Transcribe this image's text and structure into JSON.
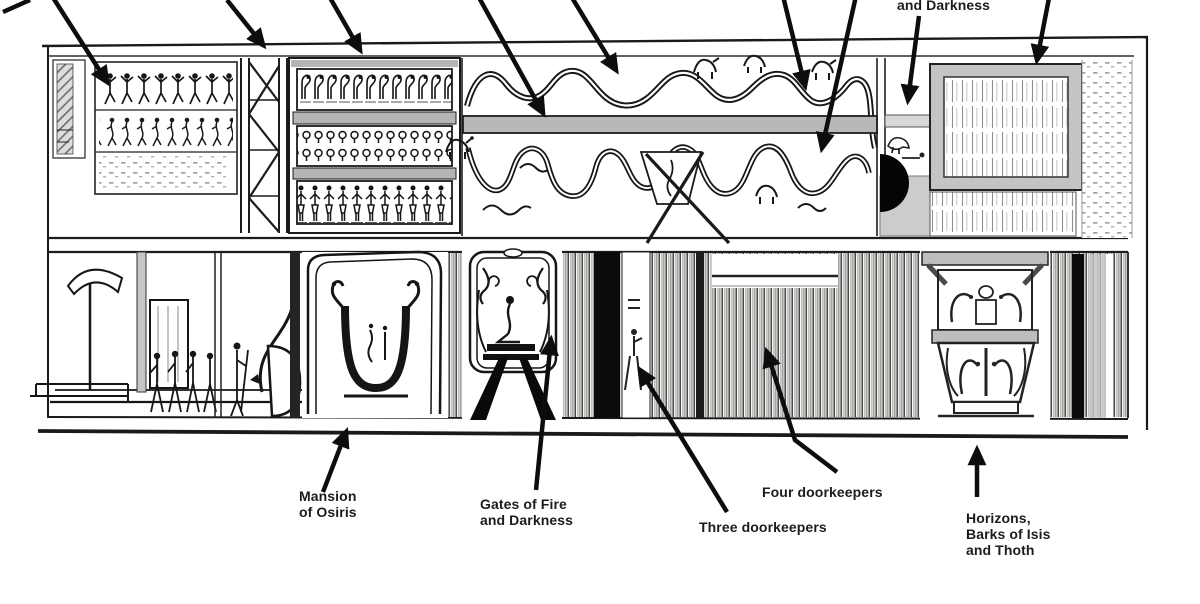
{
  "labels": {
    "top_right_partial": "and Darkness",
    "mansion": "Mansion\nof Osiris",
    "gates_fire": "Gates of Fire\nand Darkness",
    "three_doorkeepers": "Three doorkeepers",
    "four_doorkeepers": "Four doorkeepers",
    "horizons": "Horizons,\nBarks of Isis\nand Thoth"
  },
  "colors": {
    "ink": "#151515",
    "paper": "#ffffff",
    "shade_gray": "#b5b5b5",
    "panel_gray": "#c4c4c4",
    "dark_fill": "#0b0b0b"
  }
}
